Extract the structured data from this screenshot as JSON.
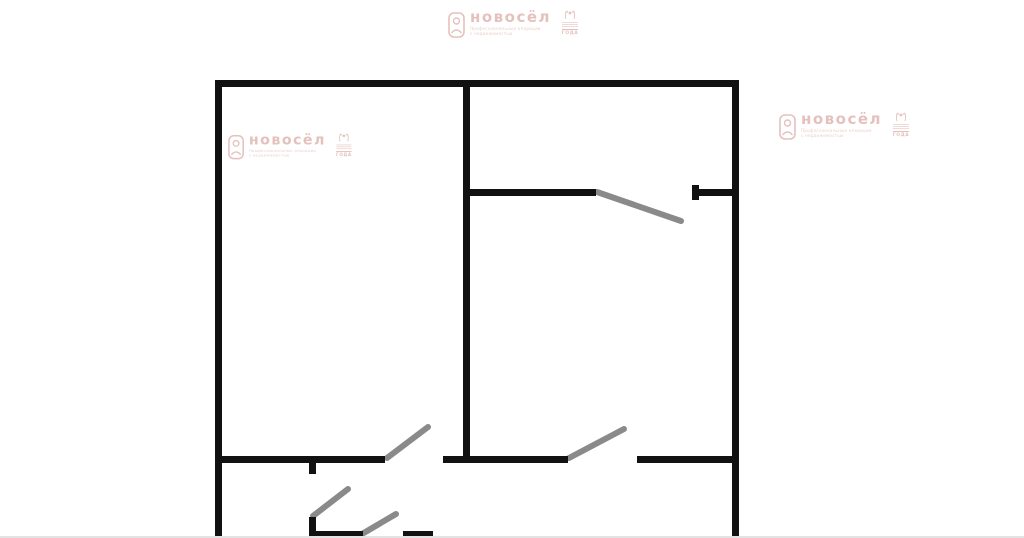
{
  "page": {
    "background": "#ffffff",
    "bottom_edge_color": "#e3e3e3"
  },
  "watermark": {
    "brand": "новосёл",
    "tagline_line1": "Профессиональные операции",
    "tagline_line2": "с недвижимостью",
    "badge_label": "ГОДА",
    "color": "#d49c96"
  },
  "floorplan": {
    "wall_color": "#111111",
    "door_color": "#8a8a8a",
    "door_stroke_width": 6,
    "walls": [
      {
        "name": "outer-left",
        "x": 215,
        "y": 80,
        "w": 7,
        "h": 458
      },
      {
        "name": "outer-top",
        "x": 215,
        "y": 80,
        "w": 524,
        "h": 7
      },
      {
        "name": "outer-right",
        "x": 732,
        "y": 80,
        "w": 7,
        "h": 458
      },
      {
        "name": "divider-vertical",
        "x": 463,
        "y": 87,
        "w": 7,
        "h": 376
      },
      {
        "name": "top-right-room-left",
        "x": 470,
        "y": 189,
        "w": 126,
        "h": 7
      },
      {
        "name": "top-right-room-right",
        "x": 692,
        "y": 189,
        "w": 40,
        "h": 7
      },
      {
        "name": "top-right-door-cap",
        "x": 692,
        "y": 185,
        "w": 7,
        "h": 15
      },
      {
        "name": "mid-wall-left",
        "x": 222,
        "y": 456,
        "w": 163,
        "h": 7
      },
      {
        "name": "mid-wall-center",
        "x": 443,
        "y": 456,
        "w": 125,
        "h": 7
      },
      {
        "name": "mid-wall-right",
        "x": 637,
        "y": 456,
        "w": 95,
        "h": 7
      },
      {
        "name": "mid-wall-stub",
        "x": 309,
        "y": 463,
        "w": 7,
        "h": 11
      },
      {
        "name": "bottom-stub-vertical",
        "x": 309,
        "y": 517,
        "w": 7,
        "h": 21
      },
      {
        "name": "bottom-wall-left",
        "x": 309,
        "y": 531,
        "w": 54,
        "h": 7
      },
      {
        "name": "bottom-wall-right",
        "x": 403,
        "y": 531,
        "w": 30,
        "h": 7
      }
    ],
    "doors": [
      {
        "name": "top-right",
        "x1": 597,
        "y1": 192,
        "x2": 681,
        "y2": 221
      },
      {
        "name": "mid-left",
        "x1": 387,
        "y1": 458,
        "x2": 428,
        "y2": 427
      },
      {
        "name": "mid-right",
        "x1": 569,
        "y1": 458,
        "x2": 624,
        "y2": 429
      },
      {
        "name": "bottom-left",
        "x1": 313,
        "y1": 516,
        "x2": 348,
        "y2": 489
      },
      {
        "name": "bottom-center",
        "x1": 362,
        "y1": 534,
        "x2": 396,
        "y2": 514
      }
    ]
  }
}
